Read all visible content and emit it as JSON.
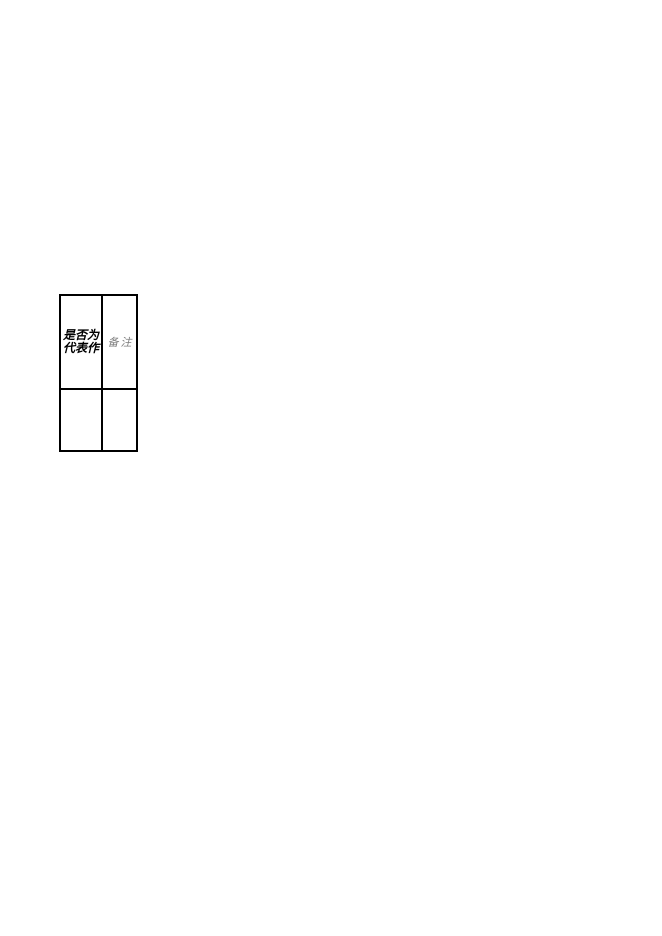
{
  "page": {
    "background_color": "#ffffff",
    "border_color": "#000000"
  },
  "table": {
    "columns": [
      {
        "header": "是否为代表作",
        "header_lines": [
          "是否为",
          "代表作"
        ],
        "header_color": "#000000",
        "header_style": "bold-italic"
      },
      {
        "header": "备注",
        "header_color": "#7d7d7d",
        "header_style": "italic"
      }
    ],
    "rows": [
      {
        "is_representative": "",
        "remarks": ""
      }
    ]
  }
}
